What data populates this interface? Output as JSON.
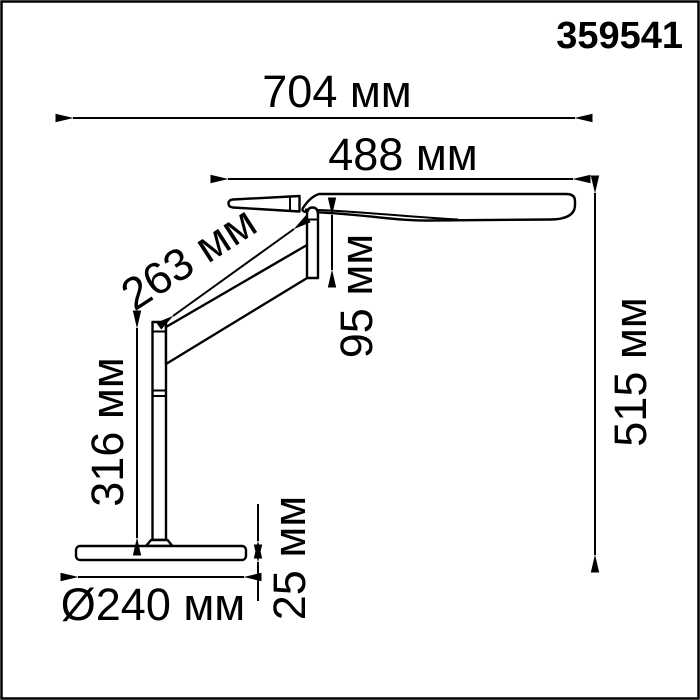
{
  "product_code": "359541",
  "drawing": {
    "type": "technical dimensional drawing",
    "subject": "desk lamp side view",
    "ink_color": "#000000",
    "paper_color": "#ffffff",
    "unit": "мм"
  },
  "dimensions": {
    "total_width": {
      "label": "704 мм",
      "value_mm": 704
    },
    "head_length": {
      "label": "488 мм",
      "value_mm": 488
    },
    "arm_length": {
      "label": "263 мм",
      "value_mm": 263
    },
    "head_drop": {
      "label": "95 мм",
      "value_mm": 95
    },
    "pole_height": {
      "label": "316 мм",
      "value_mm": 316
    },
    "total_height": {
      "label": "515 мм",
      "value_mm": 515
    },
    "base_thickness": {
      "label": "25 мм",
      "value_mm": 25
    },
    "base_diameter": {
      "label": "Ø240 мм",
      "value_mm": 240
    }
  }
}
